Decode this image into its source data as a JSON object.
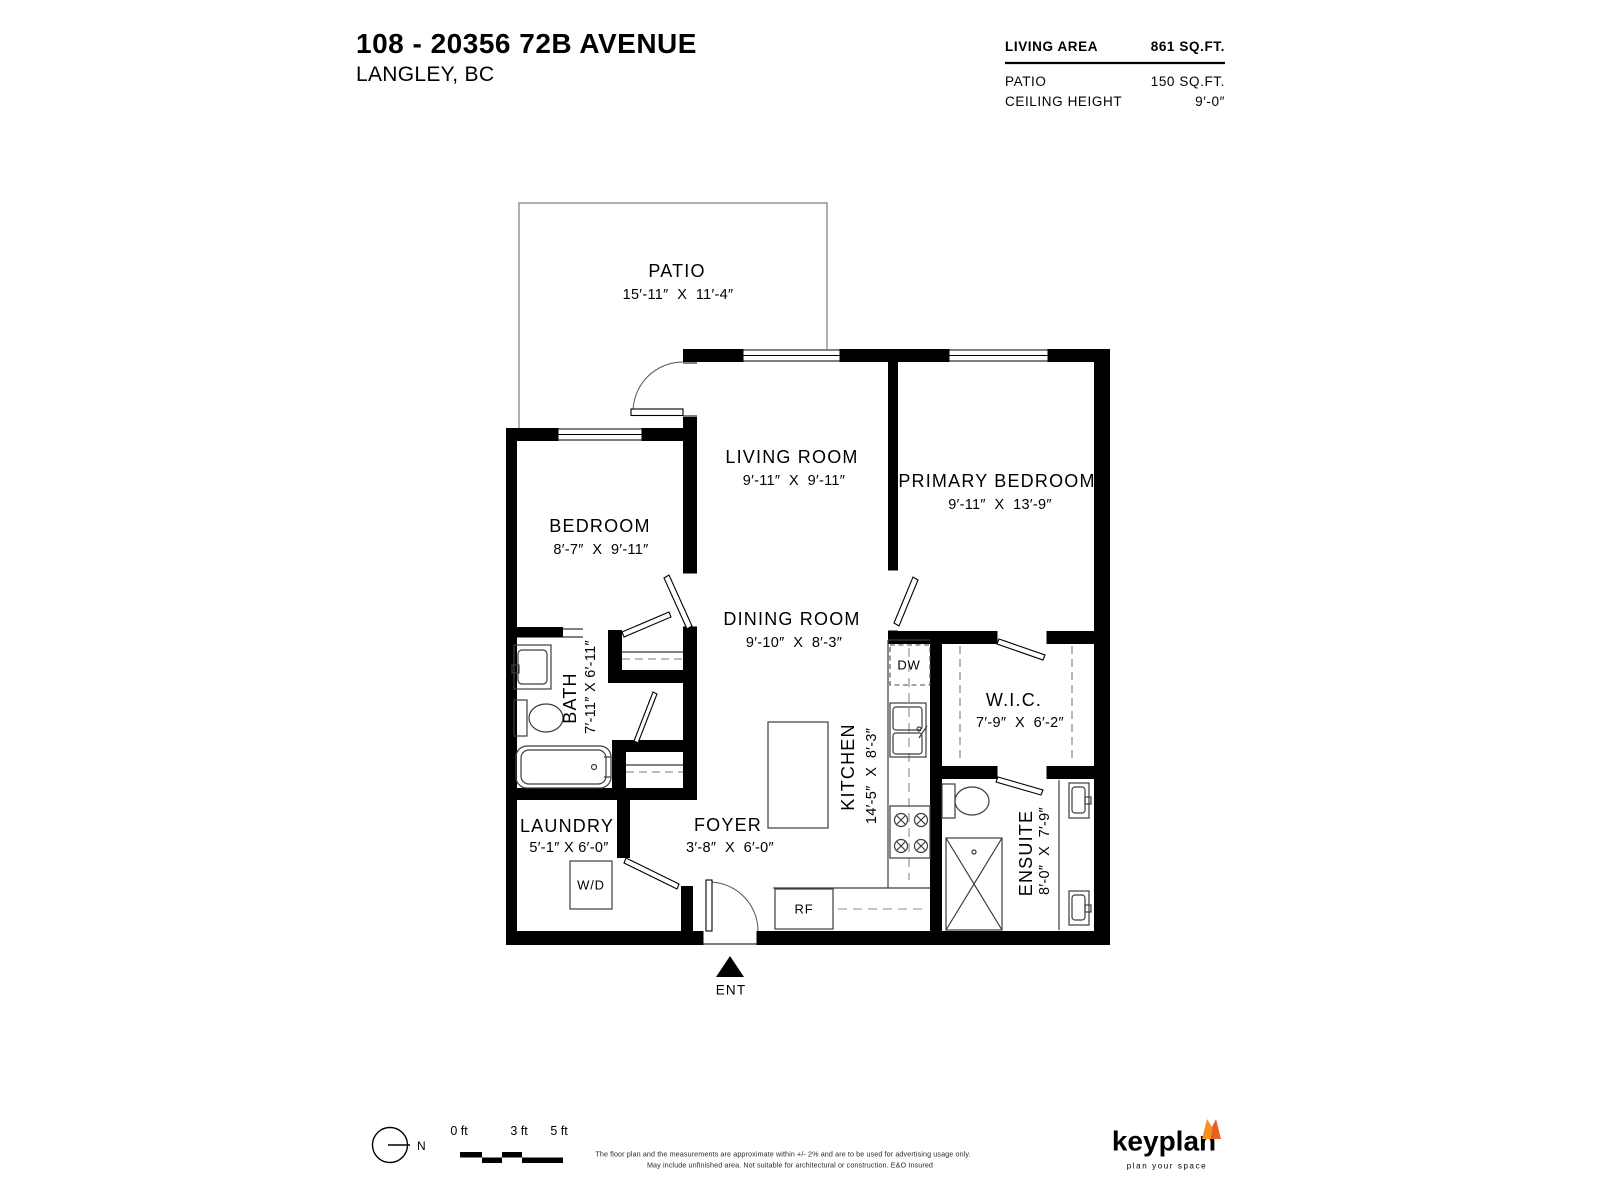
{
  "header": {
    "title": "108 - 20356 72B AVENUE",
    "subtitle": "LANGLEY, BC",
    "stats": [
      {
        "label": "LIVING AREA",
        "value": "861 SQ.FT."
      },
      {
        "label": "PATIO",
        "value": "150 SQ.FT."
      },
      {
        "label": "CEILING HEIGHT",
        "value": "9′-0″"
      }
    ]
  },
  "rooms": {
    "patio": {
      "name": "PATIO",
      "dims": "15′-11″  X  11′-4″"
    },
    "living_room": {
      "name": "LIVING ROOM",
      "dims": "9′-11″  X  9′-11″"
    },
    "primary_bedroom": {
      "name": "PRIMARY BEDROOM",
      "dims": "9′-11″  X  13′-9″"
    },
    "bedroom": {
      "name": "BEDROOM",
      "dims": "8′-7″  X  9′-11″"
    },
    "dining_room": {
      "name": "DINING ROOM",
      "dims": "9′-10″  X  8′-3″"
    },
    "bath": {
      "name": "BATH",
      "dims": "7′-11″ X 6′-11″"
    },
    "kitchen": {
      "name": "KITCHEN",
      "dims": "14′-5″  X  8′-3″"
    },
    "wic": {
      "name": "W.I.C.",
      "dims": "7′-9″  X  6′-2″"
    },
    "laundry": {
      "name": "LAUNDRY",
      "dims": "5′-1″ X 6′-0″"
    },
    "foyer": {
      "name": "FOYER",
      "dims": "3′-8″  X  6′-0″"
    },
    "ensuite": {
      "name": "ENSUITE",
      "dims": "8′-0″  X  7′-9″"
    }
  },
  "fixtures": {
    "washer_dryer": "W/D",
    "dishwasher": "DW",
    "refrigerator": "RF",
    "entry": "ENT"
  },
  "compass": {
    "north": "N"
  },
  "scale_bar": {
    "labels": [
      "0 ft",
      "3 ft",
      "5 ft"
    ]
  },
  "disclaimer": {
    "line1": "The floor plan and the measurements are approximate within +/- 2% and are to be used for advertising usage only.",
    "line2": "May include unfinished area. Not suitable for architectural or construction. E&O Insured"
  },
  "brand": {
    "name": "keyplan",
    "tagline": "plan your space",
    "colors": {
      "text": "#54565A",
      "tagline": "#A7A8AB",
      "fox_light": "#F6921E",
      "fox_dark": "#E9611E"
    }
  }
}
